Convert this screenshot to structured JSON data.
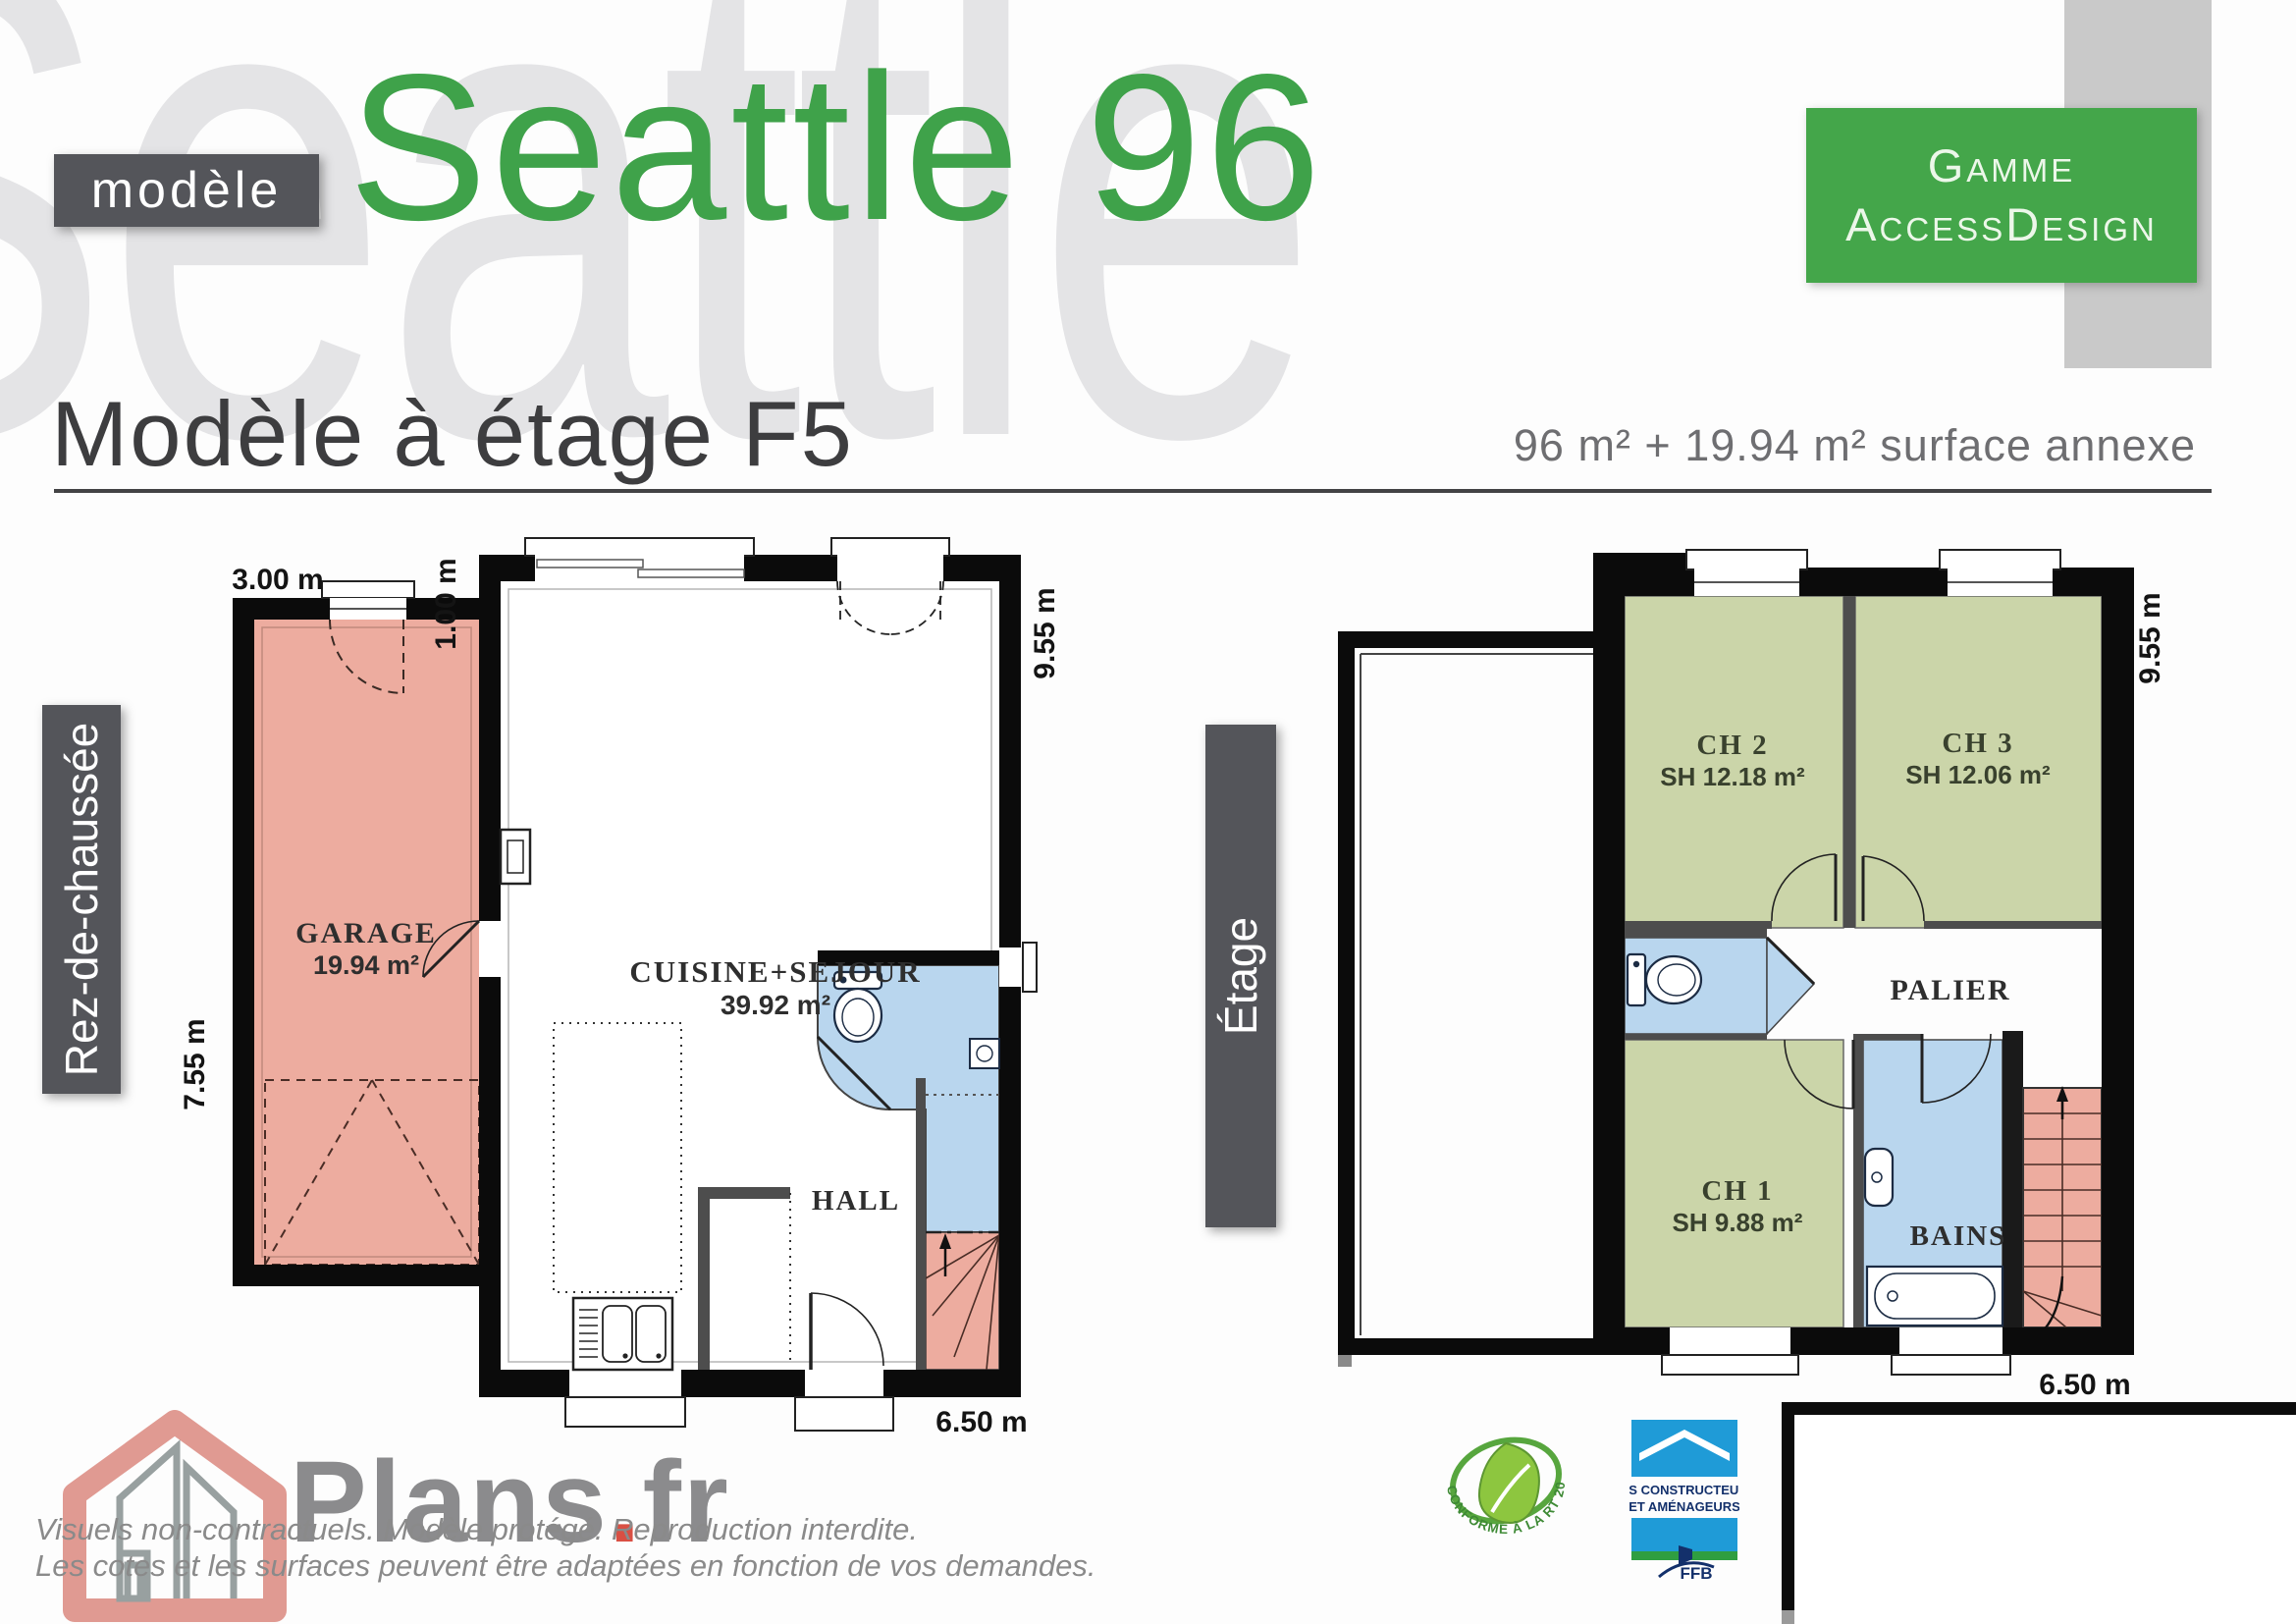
{
  "header": {
    "watermark": "Seattle",
    "model_tag": "modèle",
    "title": "Seattle 96",
    "range_line1": "Gamme",
    "range_line2": "AccessDesign",
    "subtitle": "Modèle à étage F5",
    "surface_summary": "96 m² + 19.94 m² surface annexe"
  },
  "ground_floor": {
    "label": "Rez-de-chaussée",
    "rooms": {
      "garage": {
        "name": "GARAGE",
        "area": "19.94 m²"
      },
      "kitchen_living": {
        "name": "CUISINE+SEJOUR",
        "area": "39.92 m²"
      },
      "hall": {
        "name": "HALL"
      }
    },
    "dims": {
      "garage_width": "3.00 m",
      "setback": "1.00 m",
      "height": "9.55 m",
      "garage_depth": "7.55 m",
      "width": "6.50 m"
    }
  },
  "upper_floor": {
    "label": "Étage",
    "rooms": {
      "ch2": {
        "name": "CH 2",
        "area": "SH 12.18 m²"
      },
      "ch3": {
        "name": "CH 3",
        "area": "SH 12.06 m²"
      },
      "ch1": {
        "name": "CH 1",
        "area": "SH 9.88 m²"
      },
      "palier": {
        "name": "PALIER"
      },
      "bains": {
        "name": "BAINS"
      }
    },
    "dims": {
      "height": "9.55 m",
      "width": "6.50 m"
    }
  },
  "footer": {
    "brand_name": "Plans",
    "brand_dot": ".",
    "brand_tld": "fr",
    "disclaimer_line1": "Visuels non-contractuels. Modèle protégé. Reproduction interdite.",
    "disclaimer_line2": "Les cotes et les surfaces peuvent être adaptées en fonction de vos demandes.",
    "rt2012_label": "CONFORME À LA RT 2012",
    "ffb_line1": "LES CONSTRUCTEURS",
    "ffb_line2": "ET AMÉNAGEURS",
    "ffb_acronym": "FFB"
  },
  "colors": {
    "accent_green": "#44a64a",
    "room_green": "#cbd5a9",
    "room_blue": "#b9d6ee",
    "room_pink": "#edac9f",
    "wall_black": "#0b0b0b",
    "bar_gray": "#54555a"
  }
}
